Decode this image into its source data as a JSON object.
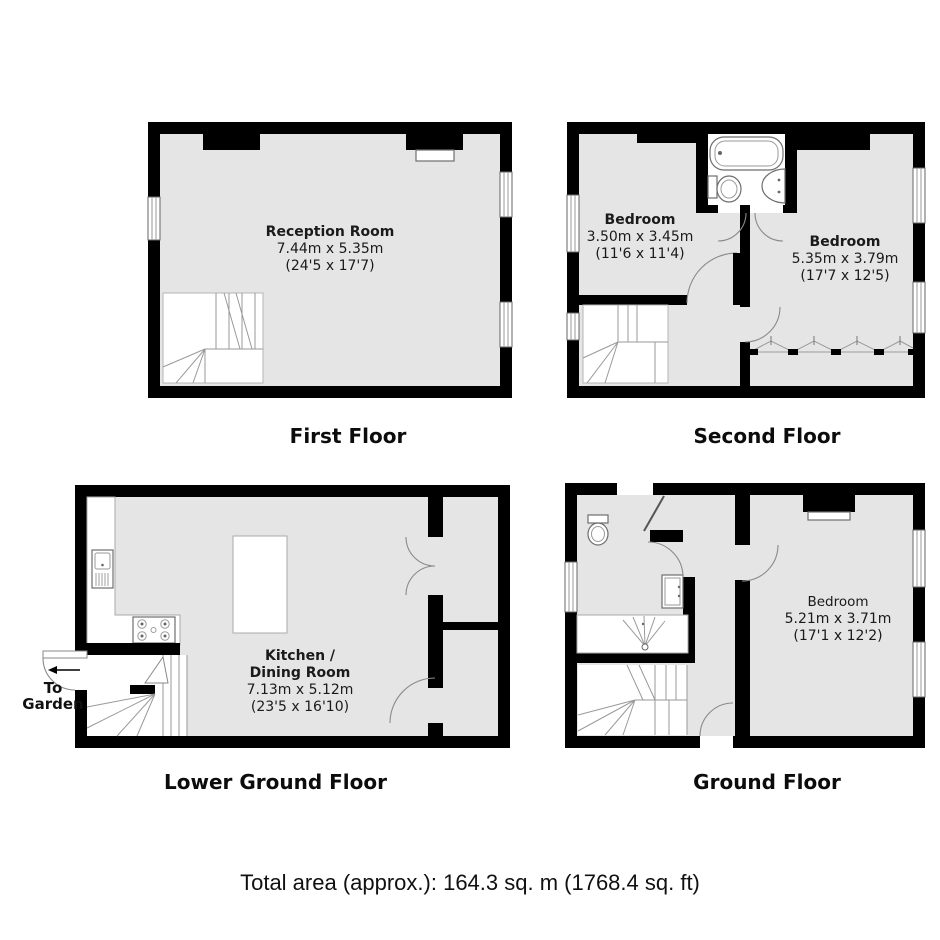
{
  "colors": {
    "wall": "#000000",
    "floor": "#e5e5e5",
    "fixture_line": "#6e6e6e"
  },
  "floors": {
    "first": {
      "title": "First Floor",
      "room": {
        "name": "Reception Room",
        "metric": "7.44m x 5.35m",
        "imperial": "(24'5 x 17'7)"
      }
    },
    "second": {
      "title": "Second Floor",
      "bedroom1": {
        "name": "Bedroom",
        "metric": "3.50m x 3.45m",
        "imperial": "(11'6 x 11'4)"
      },
      "bedroom2": {
        "name": "Bedroom",
        "metric": "5.35m x 3.79m",
        "imperial": "(17'7 x 12'5)"
      }
    },
    "lower_ground": {
      "title": "Lower Ground Floor",
      "room": {
        "name_line1": "Kitchen /",
        "name_line2": "Dining Room",
        "metric": "7.13m x 5.12m",
        "imperial": "(23'5 x 16'10)"
      }
    },
    "ground": {
      "title": "Ground Floor",
      "room": {
        "name": "Bedroom",
        "metric": "5.21m x 3.71m",
        "imperial": "(17'1 x 12'2)"
      }
    }
  },
  "annotations": {
    "to_garden": "To\nGarden"
  },
  "footer": {
    "total_area": "Total area (approx.): 164.3 sq. m (1768.4 sq. ft)"
  }
}
